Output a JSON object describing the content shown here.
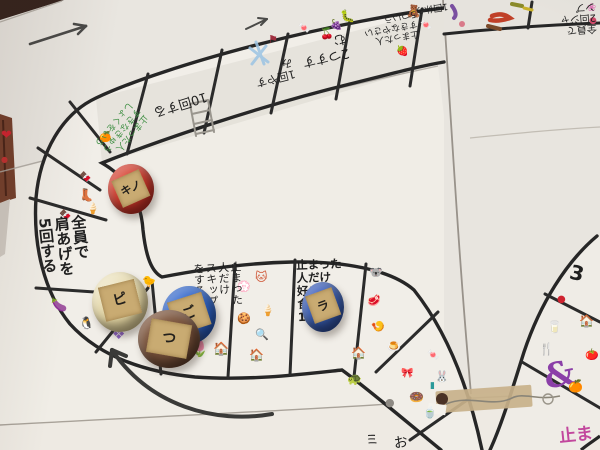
{
  "palette": {
    "ink": "#262626",
    "paper": "#ebe8e2",
    "green_ink": "#3f8f43",
    "pink_ink": "#c2479d",
    "tape": "#c8b18a"
  },
  "board": {
    "squares": {
      "do_10_times": {
        "text": "10回する"
      },
      "rest_1_a": {
        "text": "1回やすみ"
      },
      "advance_2": {
        "text": "2つすすむ"
      },
      "say_5_vegetables": {
        "text": "止まった人\nすきなやさい\n5ついう"
      },
      "rest_1_b": {
        "text": "1回休み"
      },
      "all_jump_twice": {
        "text": "全員で\n2回ジャ\nンプ"
      },
      "green_say_lunch": {
        "text": "止まった人\nすきなきゅう\nしょくをいう",
        "ink_color": "#3f8f43"
      },
      "all_shoulder_raise": {
        "text": "全員で\n肩あげを\n5回する"
      },
      "skip_if_landed": {
        "text": "止まった\n人だけ\nスキップ\nをする"
      },
      "say_1_food": {
        "text": "止まった\n人だけ\n好きな\n食べ物\n1ついう"
      },
      "number_3": {
        "text": "3"
      },
      "pink_partial": {
        "text": "止まっ",
        "ink_color": "#c2479d"
      },
      "bottom_partial_a": {
        "text": "ミ"
      },
      "bottom_partial_b": {
        "text": "お"
      }
    },
    "pieces": [
      {
        "name": "red-cap",
        "label": "キノ",
        "color": "#c23427"
      },
      {
        "name": "cream-cap",
        "label": "ピ",
        "color": "#e9dfba"
      },
      {
        "name": "blue-cap-front",
        "label": "ご",
        "color": "#2b5cb8"
      },
      {
        "name": "brown-cap",
        "label": "つ",
        "color": "#6f4b36"
      },
      {
        "name": "blue-cap-right",
        "label": "ラ",
        "color": "#3456a4"
      }
    ],
    "stickers": [
      {
        "name": "heart-sticker",
        "glyph": "❤",
        "color": "#cf2330",
        "x": 1,
        "y": 129,
        "s": 13
      },
      {
        "name": "cherries-sticker",
        "glyph": "🍒",
        "color": "#c0303a",
        "x": 320,
        "y": 28,
        "s": 11
      },
      {
        "name": "flag-sticker",
        "glyph": "⚑",
        "color": "#a03040",
        "x": 268,
        "y": 34,
        "s": 11
      },
      {
        "name": "candy-sticker",
        "glyph": "🍬",
        "color": "#d06aa0",
        "x": 298,
        "y": 24,
        "s": 10
      },
      {
        "name": "caterpillar-sticker",
        "glyph": "🐛",
        "color": "#5a9a40",
        "x": 340,
        "y": 10,
        "s": 12
      },
      {
        "name": "grapes-sticker",
        "glyph": "🍇",
        "color": "#7a4fa0",
        "x": 330,
        "y": 21,
        "s": 10
      },
      {
        "name": "gummy-bear-sticker",
        "glyph": "🧸",
        "color": "#d9a43b",
        "x": 406,
        "y": 5,
        "s": 12
      },
      {
        "name": "candy-sticker-2",
        "glyph": "🍬",
        "color": "#d04a8a",
        "x": 420,
        "y": 21,
        "s": 10
      },
      {
        "name": "strawberry-sticker",
        "glyph": "🍓",
        "color": "#c83030",
        "x": 396,
        "y": 47,
        "s": 10
      },
      {
        "name": "orange-candy-sticker",
        "glyph": "🍊",
        "color": "#e07a1a",
        "x": 99,
        "y": 133,
        "s": 10
      },
      {
        "name": "chocolate-sticker",
        "glyph": "🍫",
        "color": "#70402a",
        "x": 79,
        "y": 173,
        "s": 10
      },
      {
        "name": "boot-sticker",
        "glyph": "👢",
        "color": "#8a3020",
        "x": 79,
        "y": 189,
        "s": 12
      },
      {
        "name": "popsicle-sticker",
        "glyph": "🍦",
        "color": "#4a90d9",
        "x": 86,
        "y": 203,
        "s": 11
      },
      {
        "name": "candy-bar-sticker",
        "glyph": "🍫",
        "color": "#5a7a30",
        "x": 59,
        "y": 211,
        "s": 10
      },
      {
        "name": "eggplant-sticker",
        "glyph": "🍆",
        "color": "#5f2f66",
        "x": 51,
        "y": 299,
        "s": 13
      },
      {
        "name": "penguin-sticker",
        "glyph": "🐧",
        "color": "#30506a",
        "x": 79,
        "y": 317,
        "s": 12
      },
      {
        "name": "bird-sticker",
        "glyph": "🐤",
        "color": "#96622f",
        "x": 142,
        "y": 276,
        "s": 11
      },
      {
        "name": "gem-sticker",
        "glyph": "❖",
        "color": "#8a5fc2",
        "x": 112,
        "y": 327,
        "s": 15
      },
      {
        "name": "tulip-sticker",
        "glyph": "🌷",
        "color": "#d02a3a",
        "x": 190,
        "y": 342,
        "s": 15
      },
      {
        "name": "cat-sticker",
        "glyph": "🐱",
        "color": "#d05a3a",
        "x": 255,
        "y": 271,
        "s": 12
      },
      {
        "name": "ghost-sticker",
        "glyph": "💮",
        "color": "#d8d4cc",
        "x": 237,
        "y": 281,
        "s": 11
      },
      {
        "name": "ice-cream-sticker",
        "glyph": "🍦",
        "color": "#55b8d9",
        "x": 261,
        "y": 305,
        "s": 11
      },
      {
        "name": "cookie-sticker",
        "glyph": "🍪",
        "color": "#5a3a28",
        "x": 237,
        "y": 313,
        "s": 11
      },
      {
        "name": "mirror-sticker",
        "glyph": "🔍",
        "color": "#e07aa8",
        "x": 255,
        "y": 329,
        "s": 11
      },
      {
        "name": "house-sticker-red",
        "glyph": "🏠",
        "color": "#b03030",
        "x": 213,
        "y": 343,
        "s": 13
      },
      {
        "name": "house-sticker-pink",
        "glyph": "🏠",
        "color": "#d06a9a",
        "x": 249,
        "y": 349,
        "s": 12
      },
      {
        "name": "koala-sticker",
        "glyph": "🐨",
        "color": "#9aa0a8",
        "x": 369,
        "y": 267,
        "s": 11
      },
      {
        "name": "meat-sticker",
        "glyph": "🥩",
        "color": "#c04040",
        "x": 367,
        "y": 295,
        "s": 11
      },
      {
        "name": "fried-food-sticker",
        "glyph": "🍤",
        "color": "#e06a2a",
        "x": 371,
        "y": 321,
        "s": 11
      },
      {
        "name": "pudding-sticker",
        "glyph": "🍮",
        "color": "#e0952a",
        "x": 387,
        "y": 341,
        "s": 11
      },
      {
        "name": "house-sticker-red2",
        "glyph": "🏠",
        "color": "#b04040",
        "x": 351,
        "y": 347,
        "s": 12
      },
      {
        "name": "turtle-sticker",
        "glyph": "🐢",
        "color": "#4a7a3a",
        "x": 347,
        "y": 373,
        "s": 12
      },
      {
        "name": "bow-sticker",
        "glyph": "🎀",
        "color": "#3a3a3a",
        "x": 401,
        "y": 369,
        "s": 10
      },
      {
        "name": "candy-sticker-3",
        "glyph": "🍬",
        "color": "#d05050",
        "x": 427,
        "y": 351,
        "s": 10
      },
      {
        "name": "rabbit-sticker",
        "glyph": "🐰",
        "color": "#d9b8c8",
        "x": 435,
        "y": 371,
        "s": 11
      },
      {
        "name": "marker-sticker",
        "glyph": "▮",
        "color": "#2a9a9a",
        "x": 430,
        "y": 382,
        "s": 9
      },
      {
        "name": "stone-sticker",
        "glyph": "●",
        "color": "#8e8a84",
        "x": 385,
        "y": 397,
        "s": 11
      },
      {
        "name": "donut-sticker",
        "glyph": "🍩",
        "color": "#c0703a",
        "x": 409,
        "y": 391,
        "s": 12
      },
      {
        "name": "teacup-sticker",
        "glyph": "🍵",
        "color": "#c9a83a",
        "x": 423,
        "y": 407,
        "s": 11
      },
      {
        "name": "red-dot-sticker",
        "glyph": "●",
        "color": "#cf2330",
        "x": 557,
        "y": 295,
        "s": 10
      },
      {
        "name": "milk-carton-sticker",
        "glyph": "🥛",
        "color": "#c04040",
        "x": 547,
        "y": 321,
        "s": 12
      },
      {
        "name": "house-sticker-yellow",
        "glyph": "🏠",
        "color": "#d9a43b",
        "x": 579,
        "y": 315,
        "s": 12
      },
      {
        "name": "fork-sticker",
        "glyph": "🍴",
        "color": "#c08a2a",
        "x": 539,
        "y": 343,
        "s": 12
      },
      {
        "name": "tomato-sticker",
        "glyph": "🍅",
        "color": "#d02a2a",
        "x": 585,
        "y": 349,
        "s": 11
      },
      {
        "name": "ribbon-squiggle",
        "glyph": "&",
        "color": "#8b3fa8",
        "x": 544,
        "y": 358,
        "s": 34,
        "r": -12,
        "cls": "squiggle"
      },
      {
        "name": "orange-sticker",
        "glyph": "🍊",
        "color": "#e06010",
        "x": 568,
        "y": 380,
        "s": 12
      },
      {
        "name": "flower-sticker",
        "glyph": "❀",
        "color": "#e07ab8",
        "x": 587,
        "y": 2,
        "s": 11
      },
      {
        "name": "pink-dot-sticker",
        "glyph": "●",
        "color": "#d04a6a",
        "x": 589,
        "y": 17,
        "s": 9
      },
      {
        "name": "red-bit-sticker",
        "glyph": "●",
        "color": "#c03030",
        "x": 1,
        "y": 156,
        "s": 8
      }
    ]
  }
}
